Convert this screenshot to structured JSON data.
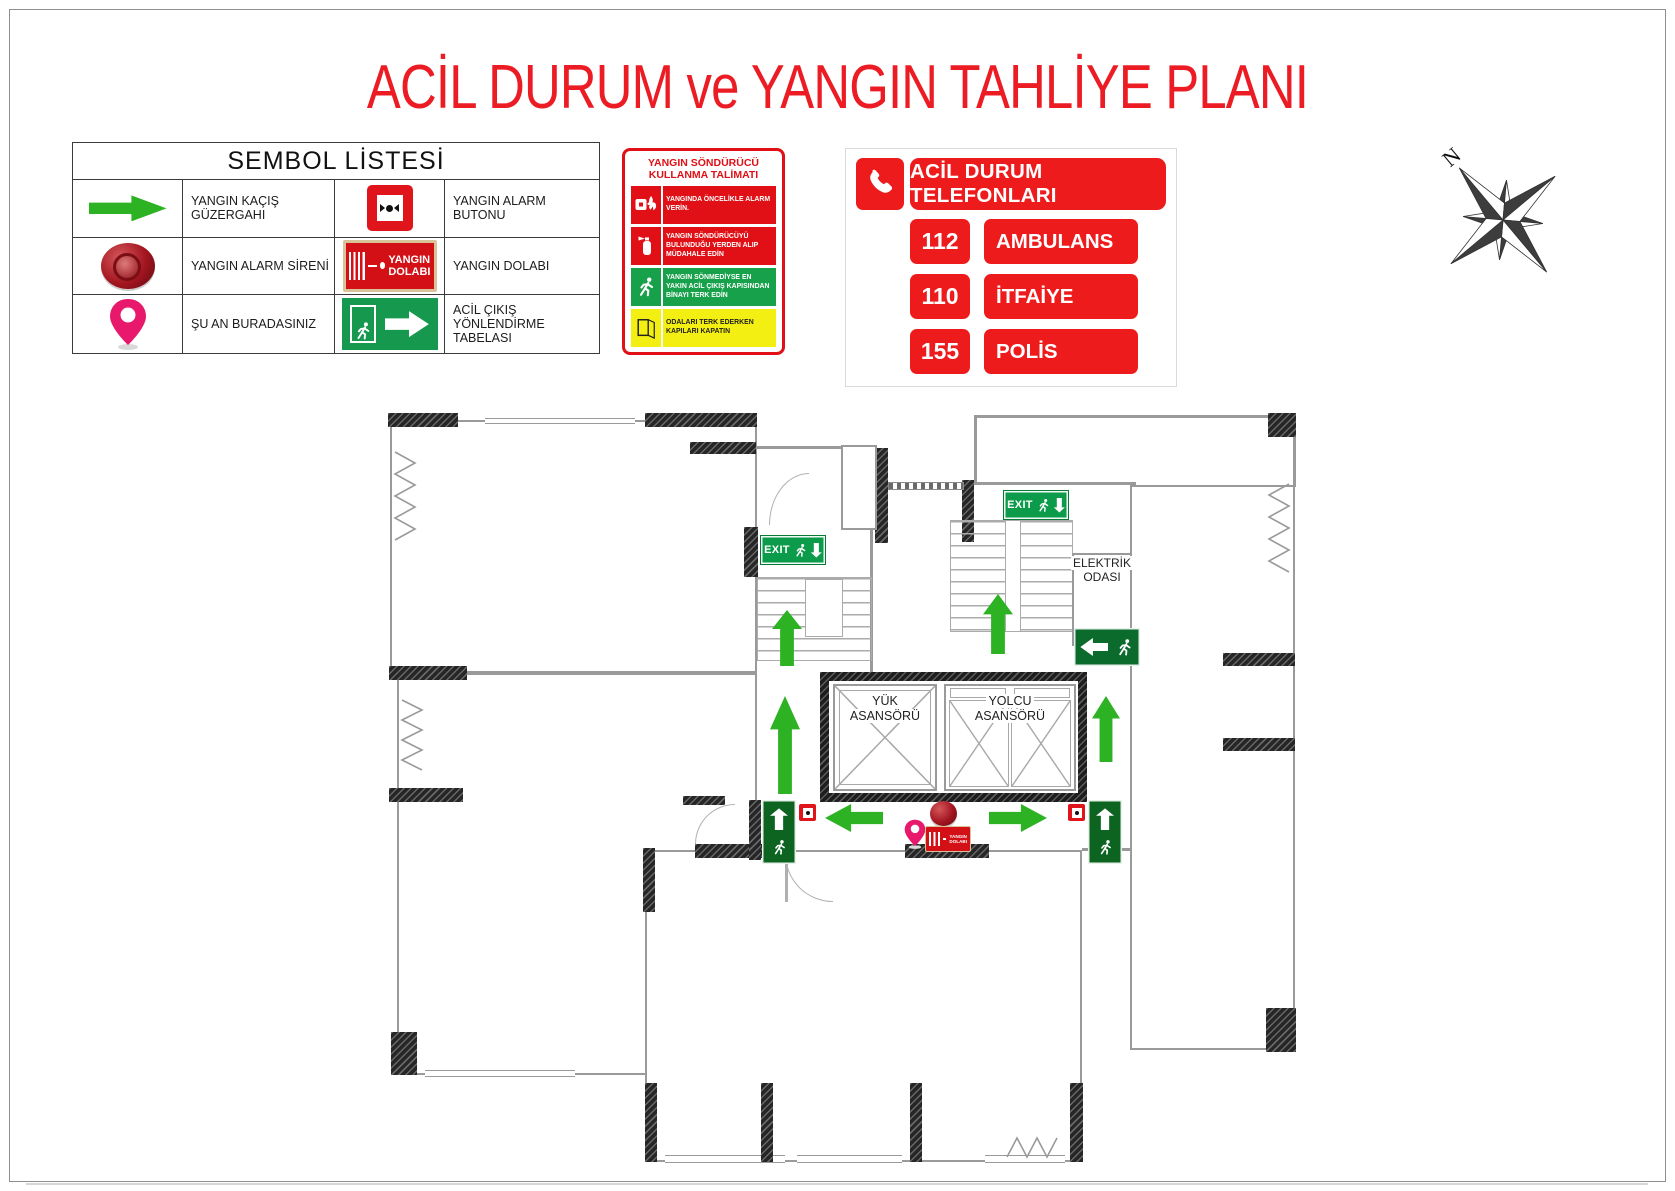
{
  "title": "ACİL DURUM ve YANGIN TAHLİYE PLANI",
  "legend": {
    "title": "SEMBOL LİSTESİ",
    "rows": [
      {
        "label1": "YANGIN KAÇIŞ GÜZERGAHI",
        "label2": "YANGIN ALARM BUTONU"
      },
      {
        "label1": "YANGIN ALARM SİRENİ",
        "label2": "YANGIN DOLABI"
      },
      {
        "label1": "ŞU AN BURADASINIZ",
        "label2": "ACİL ÇIKIŞ YÖNLENDİRME TABELASI"
      }
    ]
  },
  "instructions": {
    "title": "YANGIN SÖNDÜRÜCÜ KULLANMA TALİMATI",
    "items": [
      {
        "text": "YANGINDA ÖNCELİKLE ALARM VERİN."
      },
      {
        "text": "YANGIN SÖNDÜRÜCÜYÜ BULUNDUĞU YERDEN ALIP MÜDAHALE EDİN"
      },
      {
        "text": "YANGIN SÖNMEDİYSE EN YAKIN ACİL ÇIKIŞ KAPISINDAN BİNAYI TERK EDİN"
      },
      {
        "text": "ODALARI TERK EDERKEN KAPILARI KAPATIN"
      }
    ]
  },
  "phones": {
    "title": "ACİL DURUM TELEFONLARI",
    "entries": [
      {
        "number": "112",
        "label": "AMBULANS"
      },
      {
        "number": "110",
        "label": "İTFAİYE"
      },
      {
        "number": "155",
        "label": "POLİS"
      }
    ]
  },
  "compass": {
    "north_label": "N"
  },
  "plan": {
    "exit_label": "EXIT",
    "freight_elevator": {
      "line1": "YÜK",
      "line2": "ASANSÖRÜ"
    },
    "passenger_elevator": {
      "line1": "YOLCU",
      "line2": "ASANSÖRÜ"
    },
    "electrical_room": {
      "line1": "ELEKTRİK",
      "line2": "ODASI"
    },
    "cabinet_sign": {
      "line1": "YANGIN",
      "line2": "DOLABI"
    }
  },
  "icons": {
    "escape_route": "green-arrow-icon",
    "fire_alarm_button": "fire-alarm-button-icon",
    "fire_alarm_siren": "fire-siren-icon",
    "fire_cabinet": "fire-cabinet-sign-icon",
    "you_are_here": "location-pin-icon",
    "exit_sign": "emergency-exit-sign-icon",
    "phone": "phone-handset-icon",
    "compass": "compass-rose-icon",
    "alarm_instruction": "hand-alarm-flame-icon",
    "extinguisher": "fire-extinguisher-icon",
    "running_man": "running-man-icon",
    "door": "open-door-icon"
  },
  "colors": {
    "title_red": "#ec1c24",
    "sign_red": "#e01016",
    "phone_red": "#ee1b1d",
    "exit_green": "#0c9b4a",
    "dark_sign_green": "#0c6420",
    "arrow_green": "#2cb223",
    "pin_pink": "#e8186d",
    "instruction_yellow": "#f4ef12"
  }
}
